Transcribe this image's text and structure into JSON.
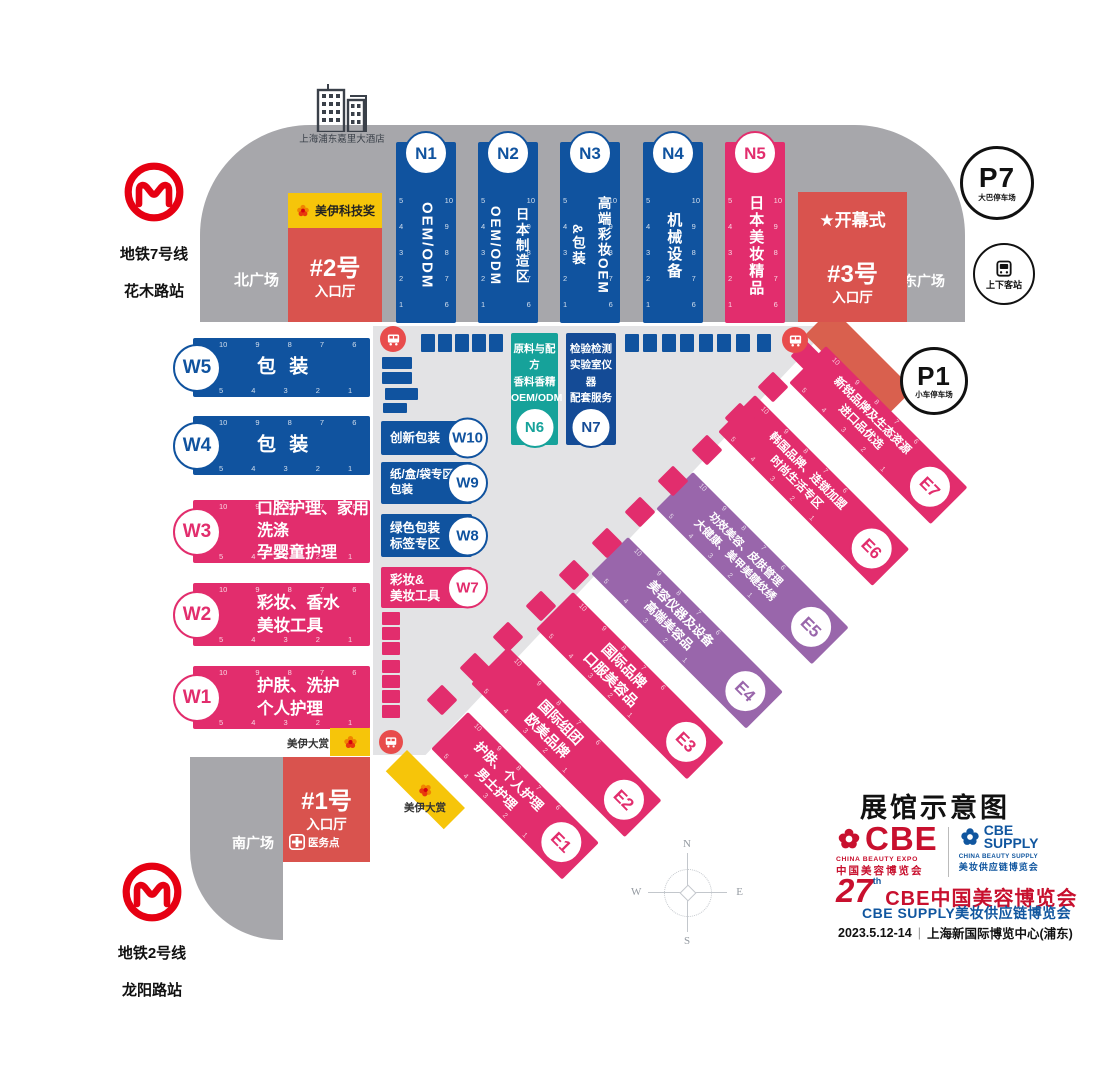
{
  "metro7": {
    "line": "地铁7号线",
    "station": "花木路站"
  },
  "metro2": {
    "line": "地铁2号线",
    "station": "龙阳路站"
  },
  "hotel": {
    "name": "上海浦东嘉里大酒店"
  },
  "plazas": {
    "north": "北广场",
    "east": "东广场",
    "south": "南广场"
  },
  "entrances": {
    "e1": {
      "no": "#1号",
      "hall": "入口厅"
    },
    "e2": {
      "no": "#2号",
      "hall": "入口厅"
    },
    "e3": {
      "no": "#3号",
      "hall": "入口厅"
    }
  },
  "opening": {
    "star": "★",
    "label": "开幕式"
  },
  "awards": {
    "tech": "美伊科技奖",
    "grand": "美伊大赏"
  },
  "medical": {
    "label": "医务点"
  },
  "parking": {
    "p7": {
      "id": "P7",
      "label": "大巴停车场"
    },
    "p1": {
      "id": "P1",
      "label": "小车停车场"
    },
    "pickup": {
      "label": "上下客站"
    }
  },
  "halls_north": [
    {
      "id": "N1",
      "text": "OEM/ODM"
    },
    {
      "id": "N2",
      "text": "日本制造区\nOEM/ODM"
    },
    {
      "id": "N3",
      "text": "高端彩妆OEM\n&包装"
    },
    {
      "id": "N4",
      "text": "机械设备"
    },
    {
      "id": "N5",
      "text": "日本美妆精品"
    }
  ],
  "halls_center": [
    {
      "id": "N6",
      "text": "原料与配方\n香料香精\nOEM/ODM"
    },
    {
      "id": "N7",
      "text": "检验检测\n实验室仪器\n配套服务"
    }
  ],
  "halls_west": [
    {
      "id": "W5",
      "text": "包 装"
    },
    {
      "id": "W4",
      "text": "包 装"
    },
    {
      "id": "W3",
      "text": "口腔护理、家用洗涤\n孕婴童护理"
    },
    {
      "id": "W2",
      "text": "彩妆、香水\n美妆工具"
    },
    {
      "id": "W1",
      "text": "护肤、洗护\n个人护理"
    }
  ],
  "halls_mid": [
    {
      "id": "W10",
      "text": "创新包装"
    },
    {
      "id": "W9",
      "text": "纸/盒/袋专区\n包装"
    },
    {
      "id": "W8",
      "text": "绿色包装\n标签专区"
    },
    {
      "id": "W7",
      "text": "彩妆&\n美妆工具"
    }
  ],
  "halls_east": [
    {
      "id": "E1",
      "text": "护肤、个人护理\n男士护理"
    },
    {
      "id": "E2",
      "text": "国际组团\n欧美品牌"
    },
    {
      "id": "E3",
      "text": "国际品牌\n口服美容品"
    },
    {
      "id": "E4",
      "text": "美容仪器及设备\n高端美容品"
    },
    {
      "id": "E5",
      "text": "功效美容、皮肤管理\n大健康、美甲美睫纹绣"
    },
    {
      "id": "E6",
      "text": "韩国品牌、连锁加盟\n时尚生活专区"
    },
    {
      "id": "E7",
      "text": "新锐品牌及生态资源\n进口品优选"
    }
  ],
  "booth_numbers": {
    "desc": "10 9 8 7 6",
    "asc": "5 4 3 2 1",
    "col_left": "5\n4\n3\n2\n1",
    "col_right": "10\n9\n8\n7\n6"
  },
  "compass": {
    "n": "N",
    "e": "E",
    "s": "S",
    "w": "W"
  },
  "branding": {
    "title": "展馆示意图",
    "cbe_name": "CBE",
    "cbe_en": "CHINA BEAUTY EXPO",
    "cbe_cn": "中国美容博览会",
    "supply_name": "CBE\nSUPPLY",
    "supply_en": "CHINA BEAUTY SUPPLY",
    "supply_cn": "美妆供应链博览会",
    "edition": "27",
    "edition_sup": "th",
    "expo_line": "CBE中国美容博览会",
    "supply_line": "CBE SUPPLY美妆供应链博览会",
    "date": "2023.5.12-14",
    "divider": "|",
    "venue": "上海新国际博览中心(浦东)"
  }
}
